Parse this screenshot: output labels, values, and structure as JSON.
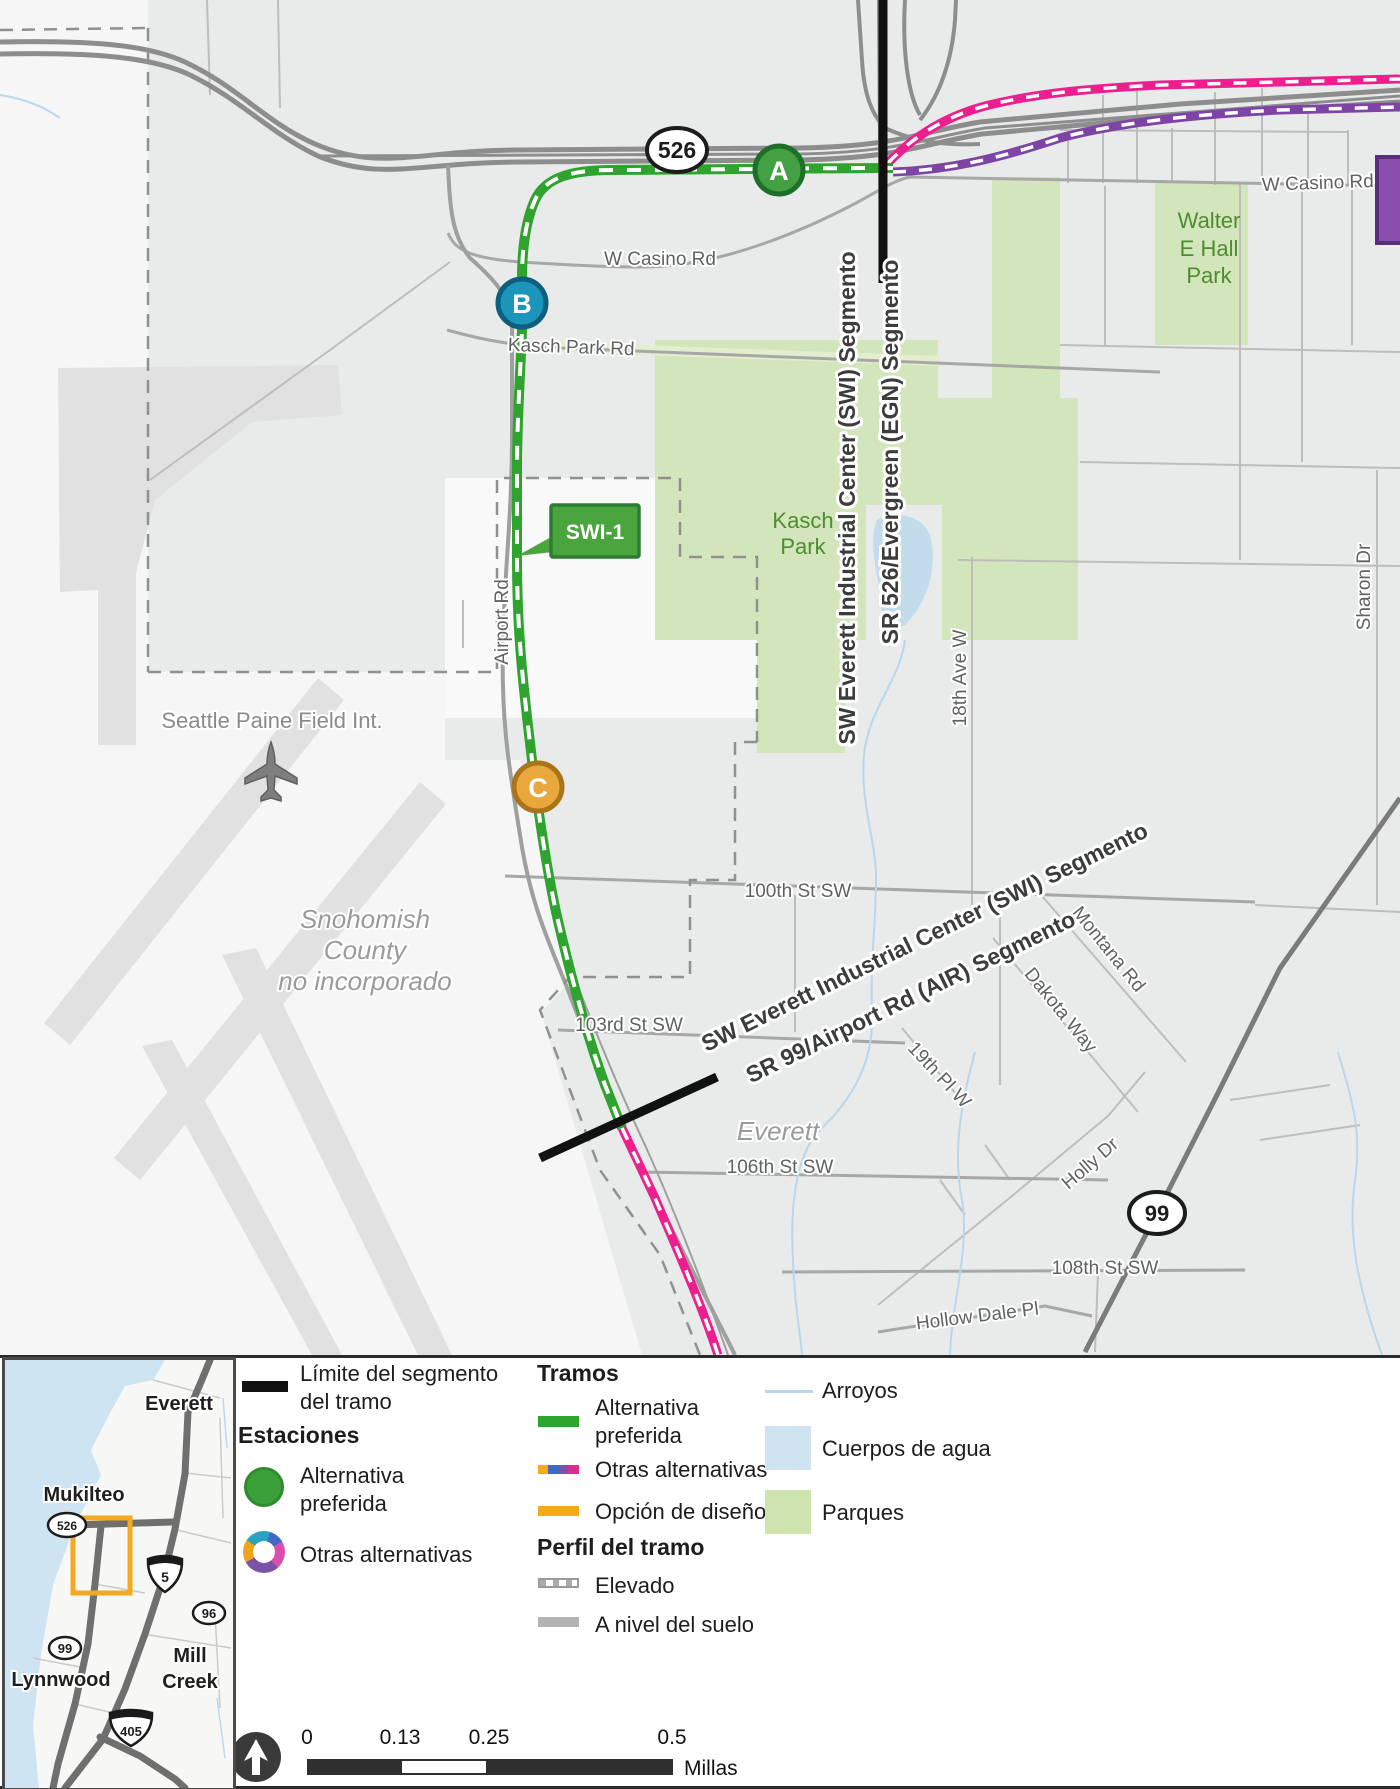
{
  "map": {
    "shield_526": "526",
    "shield_99": "99",
    "stations": {
      "a": "A",
      "b": "B",
      "c": "C"
    },
    "station_callout": "SWI-1",
    "segment_boundary_labels": {
      "swi_top": "SW Everett Industrial Center (SWI) Segmento",
      "egn": "SR 526/Evergreen (EGN) Segmento",
      "swi_bottom": "SW Everett Industrial Center (SWI) Segmento",
      "air": "SR 99/Airport Rd (AIR) Segmento"
    },
    "roads": {
      "w_casino_west": "W Casino Rd",
      "w_casino_east": "W Casino Rd",
      "kasch_park_rd": "Kasch Park Rd",
      "airport_rd": "Airport Rd",
      "st_100th": "100th St SW",
      "st_103rd": "103rd St SW",
      "st_106th": "106th St SW",
      "st_108th": "108th St SW",
      "hollow_dale_pl": "Hollow Dale Pl",
      "holly_dr": "Holly Dr",
      "dakota_way": "Dakota Way",
      "montana_rd": "Montana Rd",
      "pl_19th": "19th Pl W",
      "ave_18th": "18th Ave W",
      "sharon_dr": "Sharon Dr"
    },
    "places": {
      "kasch_park_1": "Kasch",
      "kasch_park_2": "Park",
      "walter_1": "Walter",
      "walter_2": "E Hall",
      "walter_3": "Park",
      "paine_field": "Seattle Paine Field Int.",
      "snohomish_1": "Snohomish",
      "snohomish_2": "County",
      "snohomish_3": "no incorporado",
      "everett": "Everett"
    }
  },
  "legend": {
    "limite_1": "Límite del segmento",
    "limite_2": "del tramo",
    "estaciones_header": "Estaciones",
    "estacion_preferida_1": "Alternativa",
    "estacion_preferida_2": "preferida",
    "estacion_otras": "Otras alternativas",
    "tramos_header": "Tramos",
    "tramo_preferida_1": "Alternativa",
    "tramo_preferida_2": "preferida",
    "tramo_otras": "Otras alternativas",
    "tramo_opcion": "Opción de diseño",
    "perfil_header": "Perfil del tramo",
    "perfil_elevado": "Elevado",
    "perfil_nivel": "A nivel del suelo",
    "arroyos": "Arroyos",
    "cuerpos_agua": "Cuerpos de agua",
    "parques": "Parques"
  },
  "scalebar": {
    "t0": "0",
    "t1": "0.13",
    "t2": "0.25",
    "t3": "0.5",
    "unit": "Millas"
  },
  "inset": {
    "everett": "Everett",
    "mukilteo": "Mukilteo",
    "lynnwood": "Lynnwood",
    "mill_creek_1": "Mill",
    "mill_creek_2": "Creek",
    "shield_5": "5",
    "shield_405": "405",
    "shield_96": "96",
    "shield_99": "99",
    "shield_526": "526"
  },
  "colors": {
    "preferred_green": "#2ea32e",
    "alt_pink": "#ed1f8e",
    "alt_purple": "#7d44a5",
    "design_orange": "#f8a81b",
    "station_a_green": "#43a143",
    "station_b_teal": "#1b96ba",
    "station_c_orange": "#e9a83c",
    "parks_green": "#d3e5ba",
    "water_blue": "#c6dff0",
    "boundary_black": "#111111"
  }
}
